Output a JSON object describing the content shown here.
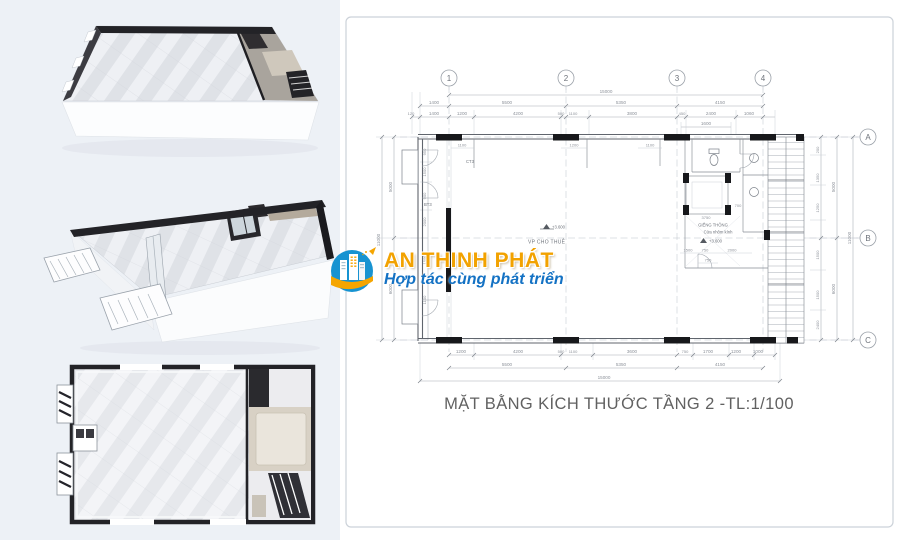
{
  "palette": {
    "left_panel_bg": "#edf1f6",
    "plan_line": "#a7adb5",
    "dim_text": "#8d929a",
    "wall_dark": "#17181b",
    "title_color": "#616161",
    "brand_gold": "#f2a200",
    "brand_blue": "#1472c4",
    "logo_circle": "#1793d1"
  },
  "watermark": {
    "brand": "AN THINH PHÁT",
    "tagline": "Hợp tác cùng phát triển",
    "logo_icon": "city-buildings-in-circle"
  },
  "plan": {
    "title": "MẶT BẰNG KÍCH THƯỚC TẦNG 2 -TL:1/100",
    "grid_columns": [
      "1",
      "2",
      "3",
      "4"
    ],
    "grid_rows": [
      "A",
      "B",
      "C"
    ],
    "dims": {
      "top_total": "15000",
      "top_spans": [
        "1400",
        "5500",
        "5350",
        "4150"
      ],
      "top_detail": [
        "120",
        "1400",
        "1200",
        "4200",
        "500",
        "1100",
        "3800",
        "450",
        "2400",
        "1060"
      ],
      "top_sub": "1600",
      "bottom_detail": [
        "1200",
        "4200",
        "500",
        "1100",
        "3600",
        "750",
        "1700",
        "1200",
        "1000"
      ],
      "bottom_spans": [
        "5500",
        "5350",
        "4150"
      ],
      "bottom_total": "15000",
      "right_detail": [
        "200",
        "1350",
        "1250",
        "1500",
        "1500",
        "2400"
      ],
      "right_spans": [
        "5000",
        "6000"
      ],
      "right_total": "11000",
      "left_detail": [
        "950",
        "1500",
        "900",
        "2000",
        "1500",
        "1100"
      ],
      "left_spans": [
        "5000",
        "6000"
      ],
      "left_total": "11000",
      "interior": [
        "1100",
        "1200",
        "1100",
        "700",
        "3750",
        "1500",
        "750",
        "2000",
        "750"
      ]
    },
    "labels": {
      "room": "VP CHO THUÊ",
      "level": "+3.600",
      "core_line1": "GIẾNG THÔNG",
      "core_line2": "Cửa nhôm kính",
      "door_tag_1": "CT3",
      "door_tag_2": "BT3"
    }
  }
}
